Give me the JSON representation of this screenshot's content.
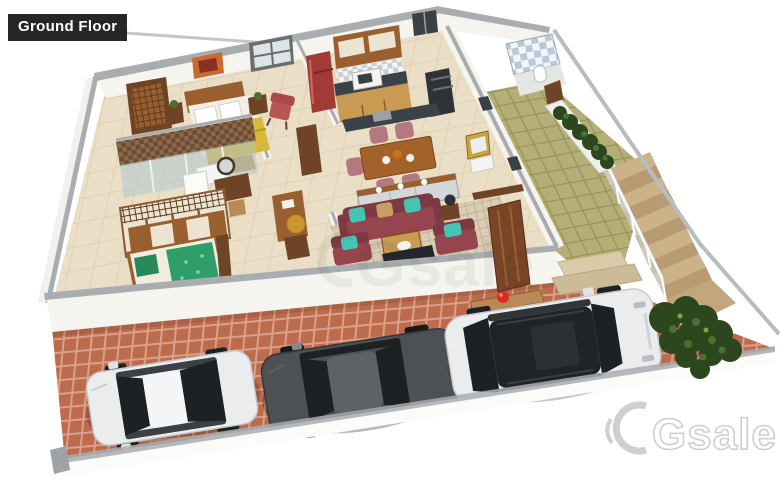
{
  "canvas": {
    "width": 780,
    "height": 490,
    "background": "#ffffff"
  },
  "badge": {
    "text": "Ground Floor"
  },
  "watermark": {
    "brand": "Gsale",
    "center_text": "Gsale"
  },
  "palette": {
    "badge_bg": "#262626",
    "badge_text": "#ffffff",
    "wall_face": "#f6f4ef",
    "wall_top": "#a9adb0",
    "floor_int": "#eadfc6",
    "floor_line": "#cdbd9a",
    "brick": "#bc6b4d",
    "brick_line": "#daa189",
    "patio": "#b4af78",
    "patio_line": "#96914f",
    "stair": "#ccb289",
    "stair_dark": "#b89b72",
    "mosaic_a": "#6e4c34",
    "mosaic_b": "#8a6a4d",
    "tile_blue": "#b8c9d9",
    "rug": "#d9cdb4",
    "sofa": "#96454f",
    "cushion_teal": "#45c4b4",
    "cushion_tan": "#c89f63",
    "chair_mauve": "#b5787e",
    "bed_blanket": "#d9b93a",
    "bed_green": "#2f9e68",
    "wood_dark": "#6f4426",
    "wood_mid": "#9a5f2e",
    "wood_light": "#c89a52",
    "cream": "#ece4d2",
    "fridge": "#a23a36",
    "counter_dark": "#3c4248",
    "steel": "#9aa2a8",
    "hedge": "#2c461d",
    "hedge_light": "#4d7030",
    "car_white": "#eaeced",
    "car_dark": "#4d5154",
    "car_glass": "#1d2124",
    "red_accent": "#df2b1f",
    "watermark": "#cfcfcf",
    "glass_rail": "#cfe2ea"
  },
  "scene": {
    "type": "isometric-3d-floor-plan",
    "floor": "Ground Floor",
    "rooms": [
      "master-bedroom",
      "bathroom",
      "dressing-closet",
      "second-bedroom",
      "kitchen",
      "dining-area",
      "living-room",
      "foyer",
      "washroom",
      "patio"
    ],
    "outdoor": [
      "driveway",
      "staircase",
      "glass-railing",
      "planter-hedge",
      "corner-hedge",
      "compound-wall"
    ],
    "furniture": [
      "double-bed",
      "lattice-wardrobe",
      "wall-art",
      "window",
      "bedside-tables",
      "refrigerator",
      "kitchen-cabinets",
      "microwave",
      "cooktop-tower",
      "sink-island",
      "dining-table",
      "dining-chairs",
      "sideboard",
      "sofa-set",
      "armchairs",
      "coffee-table",
      "tv-console",
      "study-desk",
      "shower-enclosure",
      "vanity-mirror",
      "closet-cabinets",
      "single-bed",
      "entrance-door",
      "entrance-steps"
    ],
    "vehicles": [
      "white-hatchback",
      "grey-sedan",
      "white-suv"
    ],
    "props": [
      "red-ball",
      "table-lamp",
      "gold-pouf",
      "potted-plants"
    ]
  }
}
